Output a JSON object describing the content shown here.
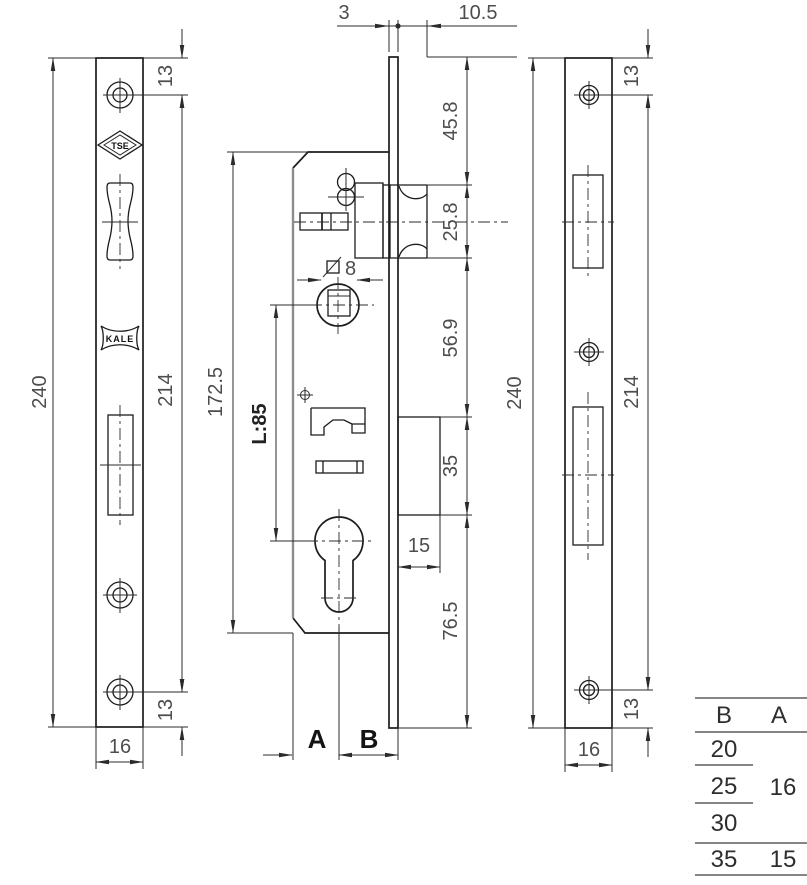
{
  "left_view": {
    "overall_height": "240",
    "screw_top": "13",
    "screw_span": "214",
    "screw_bottom": "13",
    "width": "16",
    "logo_top": "TSE",
    "logo_brand": "KALE"
  },
  "center_view": {
    "faceplate_thickness": "3",
    "backplate_offset": "10.5",
    "body_height": "172.5",
    "axis_distance": "L:85",
    "spindle_square": "8",
    "chain": {
      "c1": "45.8",
      "c2": "25.8",
      "c3": "56.9",
      "c4": "35",
      "c5": "15",
      "c6": "76.5"
    },
    "label_a": "A",
    "label_b": "B"
  },
  "right_view": {
    "overall_height": "240",
    "screw_top": "13",
    "screw_span": "214",
    "screw_bottom": "13",
    "width": "16"
  },
  "table": {
    "headers": [
      "B",
      "A"
    ],
    "b_values": [
      "20",
      "25",
      "30",
      "35"
    ],
    "a_value_top": "16",
    "a_value_bottom": "15"
  }
}
